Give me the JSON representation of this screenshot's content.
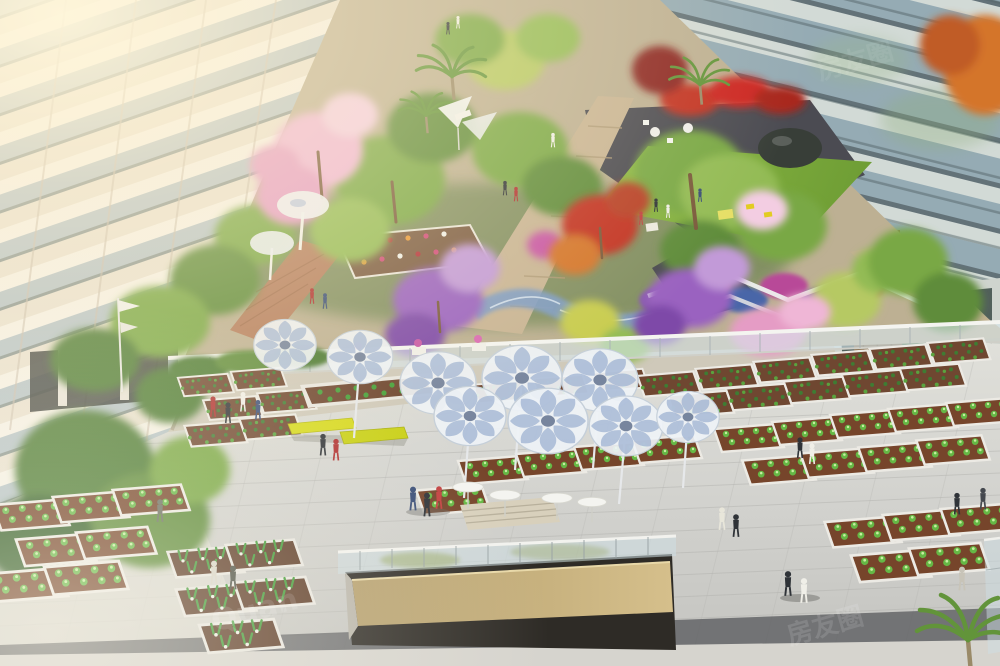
{
  "scene": {
    "labels": {
      "left_building": "residential tower with balconies in warm sunlight",
      "right_building": "glass curtain-wall building",
      "background_building": "colonnade building at rear of courtyard",
      "upper_garden": "landscaped flower garden with lawn, palms and colored trees",
      "lower_terrace": "community farming terrace with raised vegetable planters",
      "canopies": "petal-shaped shade canopy cluster",
      "balustrade": "glass balustrade between garden and terrace",
      "sunken_court": "sunken light well with tan wall and glass railing",
      "people": "residents walking and sitting",
      "bench": "yellow bench",
      "watermark": "diagonal translucent watermark"
    }
  },
  "watermark": {
    "latin": "Quan",
    "cjk": "房友圈"
  },
  "palette": {
    "sun_glow": "#fff3d2",
    "left_facade": "#e9e1d1",
    "balcony_glass": "#b7c4c8",
    "right_glass": "#87a0aa",
    "lawn_green": "#86b23f",
    "dark_plaza": "#4b4b52",
    "path_beige": "#c8b494",
    "blossom_pink": "#efb6d6",
    "flower_purple": "#9a62c0",
    "flower_red": "#c23324",
    "canopy_blue": "#9db1d2",
    "planter_soil": "#6f4731",
    "veg_green": "#65b845",
    "pavement": "#d6d6d2",
    "pit_wall_tan": "#cdb886",
    "bench_yellow": "#d6d91e"
  }
}
